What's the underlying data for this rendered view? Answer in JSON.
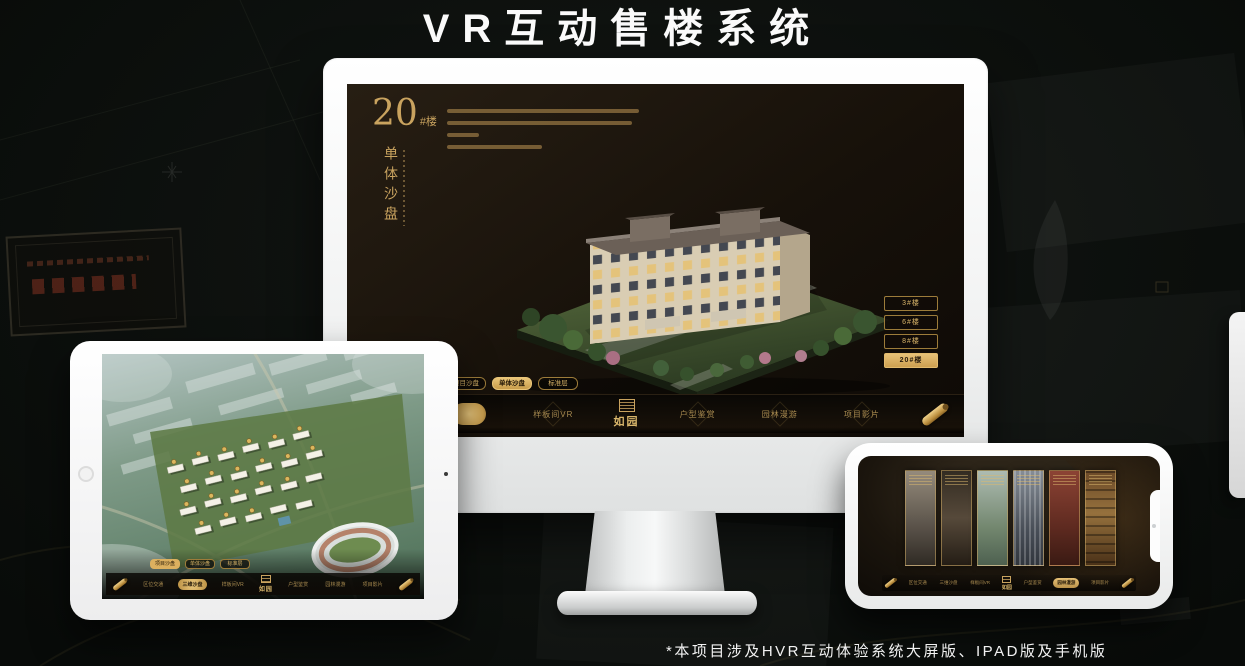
{
  "page": {
    "title": "VR互动售楼系统",
    "footnote": "*本项目涉及HVR互动体验系统大屏版、IPAD版及手机版"
  },
  "brand": {
    "logo_text": "如园",
    "accent_gold": "#c9a35f",
    "accent_gold_bright": "#e7c177",
    "screen_background": "#16100a"
  },
  "nav": {
    "items": [
      "区位交通",
      "三维沙盘",
      "样板间VR",
      "户型鉴赏",
      "园林漫游",
      "项目影片"
    ]
  },
  "monitor": {
    "unit_number": "20",
    "unit_suffix": "#楼",
    "panel_title": "单体沙盘",
    "floor_buttons": [
      "3#楼",
      "6#楼",
      "8#楼",
      "20#楼"
    ],
    "active_floor": "20#楼",
    "sub_tabs": [
      "项目沙盘",
      "单体沙盘",
      "标准层"
    ],
    "active_sub_tab": "单体沙盘",
    "active_nav_item": "三维沙盘"
  },
  "tablet": {
    "sub_tabs": [
      "项目沙盘",
      "单体沙盘",
      "标准层"
    ],
    "active_sub_tab": "项目沙盘",
    "active_nav_item": "三维沙盘"
  },
  "phone": {
    "active_nav_item": "园林漫游",
    "panorama_card_count": 6
  }
}
